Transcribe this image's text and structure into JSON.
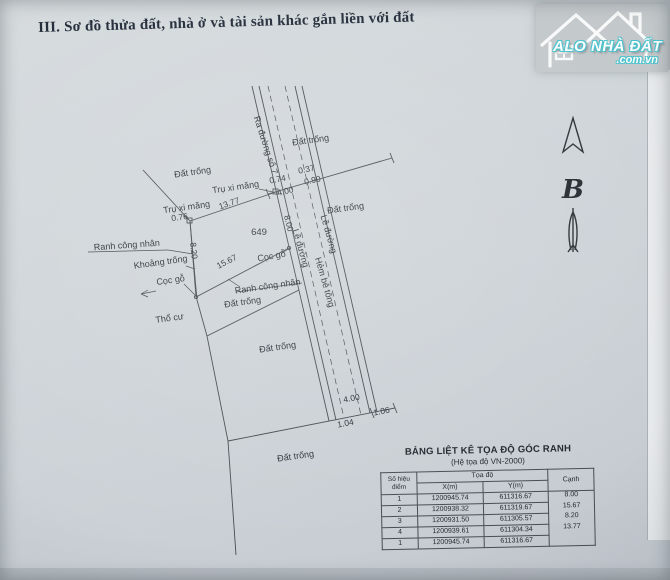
{
  "page": {
    "title": "III. Sơ đồ thửa đất, nhà ở và tài sản khác gắn liền với đất"
  },
  "logo": {
    "name": "ALO NHÀ ĐẤT",
    "domain": ".com.vn",
    "accent_color": "#4cc3cd"
  },
  "north_arrow": {
    "label": "B"
  },
  "diagram": {
    "parcel_number": "649",
    "labels": {
      "dat_trong": "Đất trống",
      "tru_xi_mang": "Trụ xi măng",
      "ranh_cong_nhan": "Ranh công nhân",
      "khoang_trong": "Khoảng trống",
      "coc_go": "Cọc gỗ",
      "tho_cu": "Thổ cư",
      "le_duong": "Lề đường",
      "hem_be_tong": "Hẻm bê tông",
      "ra_duong_so_7": "Ra đường số 7"
    },
    "measurements": {
      "top_edge": "13.77",
      "left_edge": "8.20",
      "bottom_edge": "15.67",
      "right_edge": "8.00",
      "m076": "0.76",
      "m074": "0.74",
      "m400": "4.00",
      "m037": "0.37",
      "m090": "0.90",
      "m104": "1.04",
      "m106": "1.06"
    }
  },
  "table": {
    "title": "BẢNG LIỆT KÊ TỌA ĐỘ GÓC RANH",
    "subtitle": "(Hệ tọa độ VN-2000)",
    "col_point": "Số hiệu điểm",
    "col_coords": "Tọa độ",
    "col_x": "X(m)",
    "col_y": "Y(m)",
    "col_edge": "Cạnh",
    "rows": [
      {
        "point": "1",
        "x": "1200945.74",
        "y": "611316.67"
      },
      {
        "point": "2",
        "x": "1200938.32",
        "y": "611319.67"
      },
      {
        "point": "3",
        "x": "1200931.50",
        "y": "611305.57"
      },
      {
        "point": "4",
        "x": "1200939.61",
        "y": "611304.34"
      },
      {
        "point": "1",
        "x": "1200945.74",
        "y": "611316.67"
      }
    ],
    "edges": [
      "8.00",
      "15.67",
      "8.20",
      "13.77"
    ]
  }
}
